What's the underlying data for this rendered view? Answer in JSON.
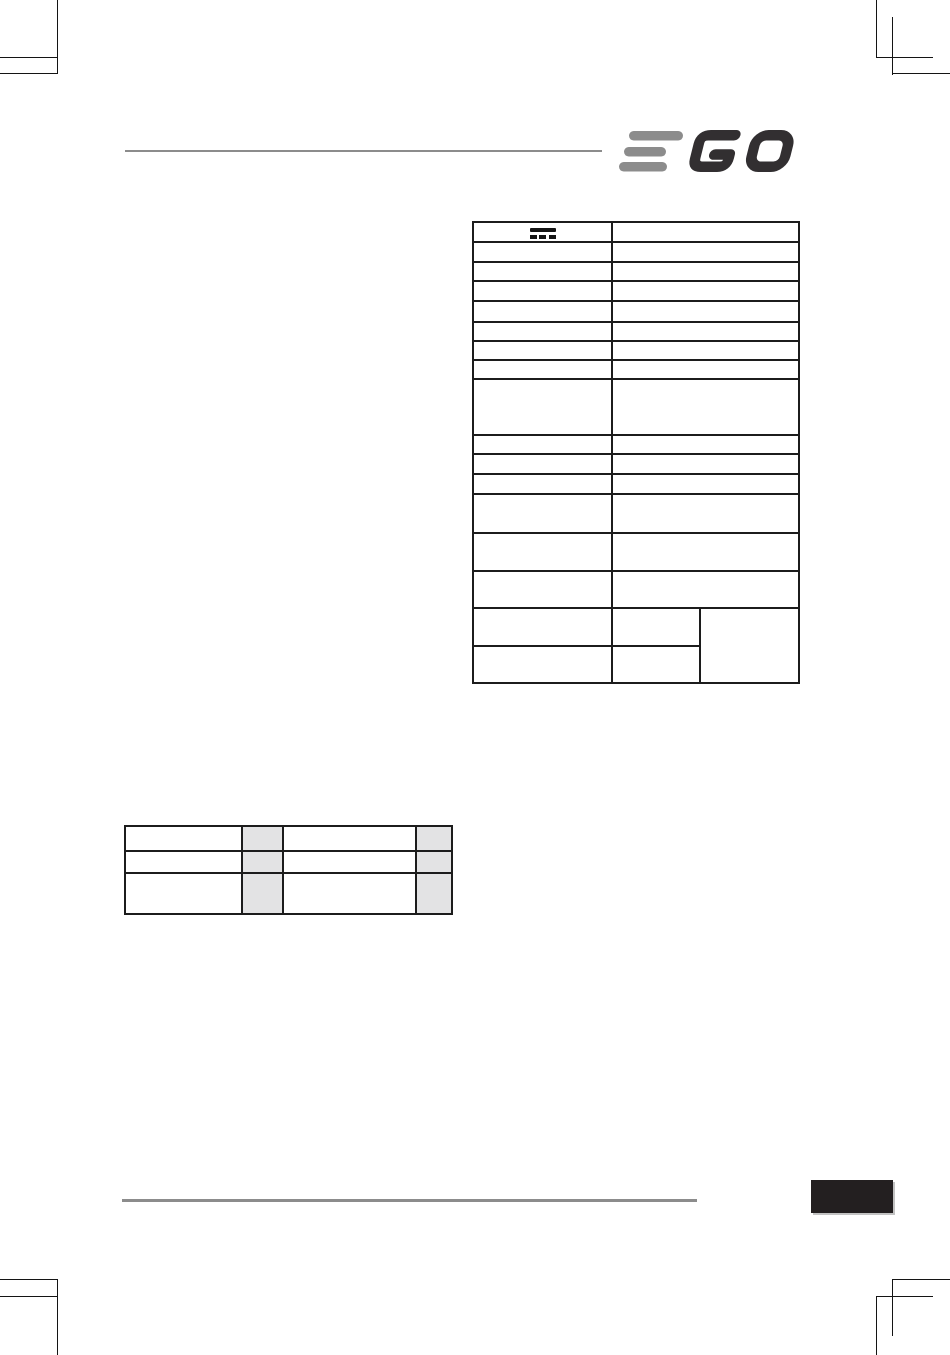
{
  "document": {
    "brand": "EGO",
    "page_marker_text": ""
  },
  "colors": {
    "logo_e_gray": "#8c8c8c",
    "logo_go_dark": "#322f31",
    "rule_gray": "#8c8c8c",
    "table_border": "#1c1c1c",
    "shaded_cell": "#e3e3e4",
    "page_marker_box": "#231f20",
    "crop_mark": "#141414"
  },
  "icons": {
    "direct_current": {
      "name": "direct-current-icon",
      "label": "direct current (DC) symbol"
    }
  },
  "spec_table": {
    "columns": 2,
    "row_count": 17,
    "rows": [
      {
        "icon": "direct-current-icon",
        "cells": [
          "",
          ""
        ]
      },
      {
        "cells": [
          "",
          ""
        ]
      },
      {
        "cells": [
          "",
          ""
        ]
      },
      {
        "cells": [
          "",
          ""
        ]
      },
      {
        "cells": [
          "",
          ""
        ]
      },
      {
        "cells": [
          "",
          ""
        ]
      },
      {
        "cells": [
          "",
          ""
        ]
      },
      {
        "cells": [
          "",
          ""
        ]
      },
      {
        "cells": [
          "",
          ""
        ]
      },
      {
        "cells": [
          "",
          ""
        ]
      },
      {
        "cells": [
          "",
          ""
        ]
      },
      {
        "cells": [
          "",
          ""
        ]
      },
      {
        "cells": [
          "",
          ""
        ]
      },
      {
        "cells": [
          "",
          ""
        ]
      },
      {
        "cells": [
          "",
          ""
        ]
      },
      {
        "cells": [
          "",
          "",
          ""
        ],
        "merged_right_cell": true
      },
      {
        "cells": [
          "",
          ""
        ]
      }
    ]
  },
  "measurement_table": {
    "columns": 4,
    "shaded_columns": [
      2,
      4
    ],
    "rows": [
      {
        "cells": [
          "",
          "",
          "",
          ""
        ]
      },
      {
        "cells": [
          "",
          "",
          "",
          ""
        ]
      },
      {
        "cells": [
          "",
          "",
          "",
          ""
        ]
      }
    ]
  }
}
